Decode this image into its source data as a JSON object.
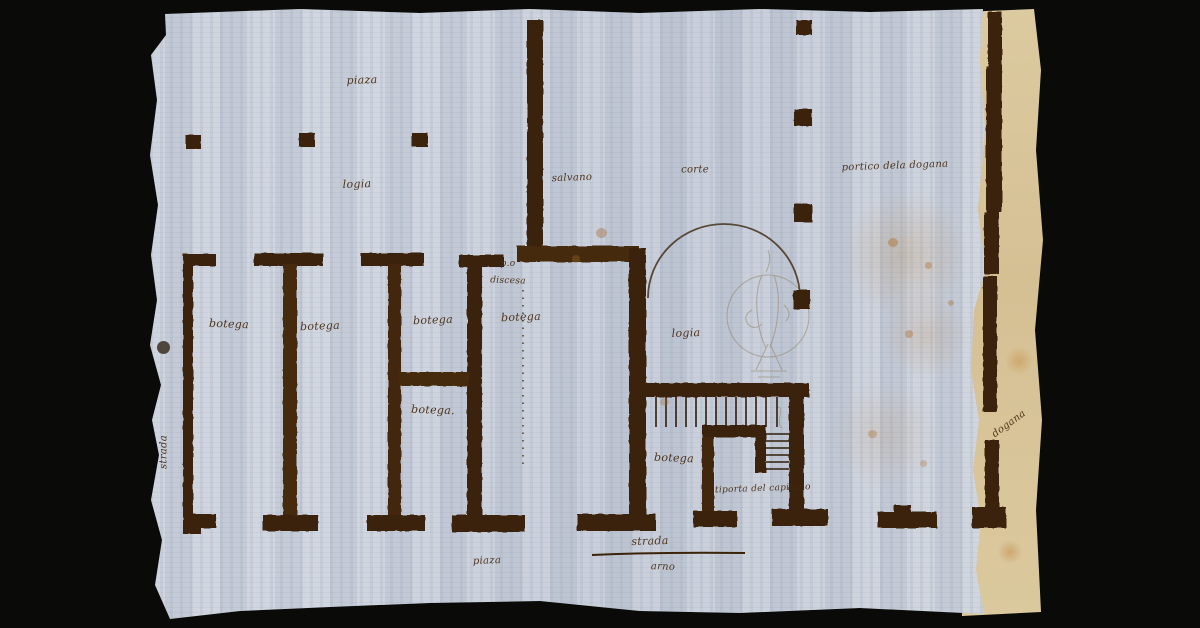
{
  "artwork": {
    "type": "hand-drawn architectural floor plan, ink on laid paper",
    "background_color": "#0a0a08",
    "paper_color": "#cbd1db",
    "backing_paper_color": "#d8c69c",
    "ink_color": "#3a2309",
    "pencil_color": "#93866e"
  },
  "labels": {
    "piazza_top": "piaza",
    "loggia_top": "logia",
    "salvano": "salvano",
    "corte": "corte",
    "portico_dogana": "portico dela dogana",
    "pio": "p.o",
    "discesa": "discesa",
    "botega_1": "botega",
    "botega_2": "botega",
    "botega_3": "botega",
    "botega_4": "botega",
    "botega_5": "botega.",
    "loggia_mid": "logia",
    "botega_6": "botega",
    "antiporta": "antiporta del capitano",
    "strada_left": "strada",
    "dogana_right": "dogana",
    "strada_bottom": "strada",
    "arno": "arno",
    "piazza_bottom": "piaza"
  }
}
